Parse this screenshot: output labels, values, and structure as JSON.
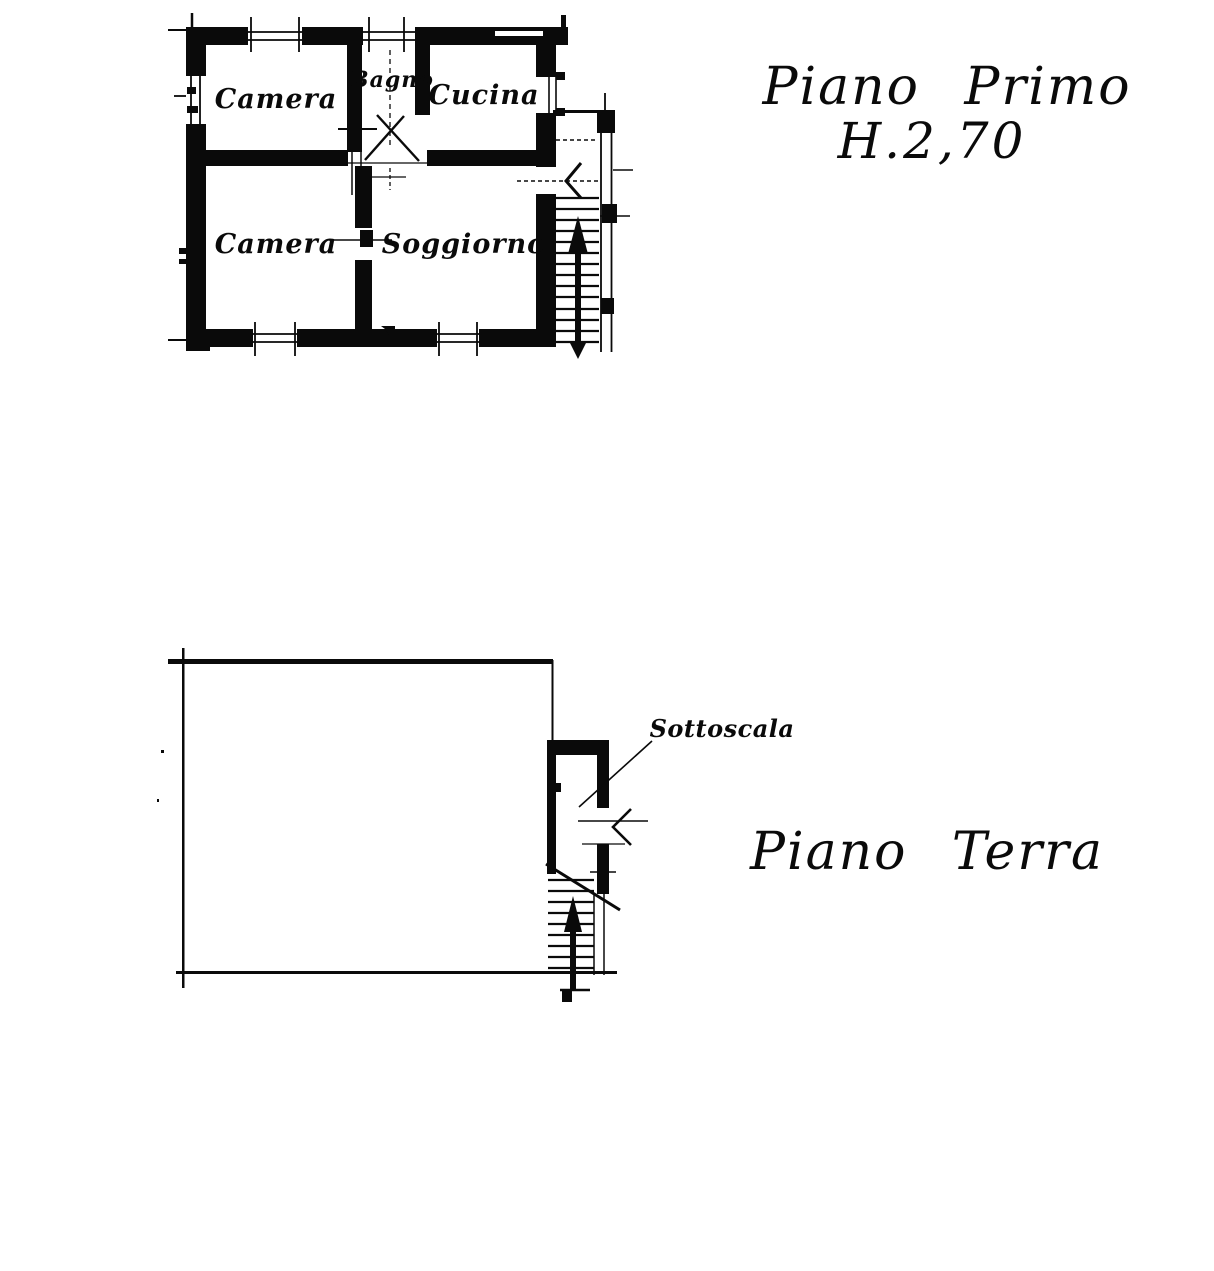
{
  "page": {
    "background_color": "#ffffff",
    "ink_color": "#0a0a0a"
  },
  "first_floor": {
    "title": "Piano Primo",
    "height_label": "H.2,70",
    "rooms": {
      "camera_top": "Camera",
      "bagno": "Bagno",
      "cucina": "Cucina",
      "camera_bottom": "Camera",
      "soggiorno": "Soggiorno"
    }
  },
  "ground_floor": {
    "title": "Piano Terra",
    "sottoscala_label": "Sottoscala"
  }
}
